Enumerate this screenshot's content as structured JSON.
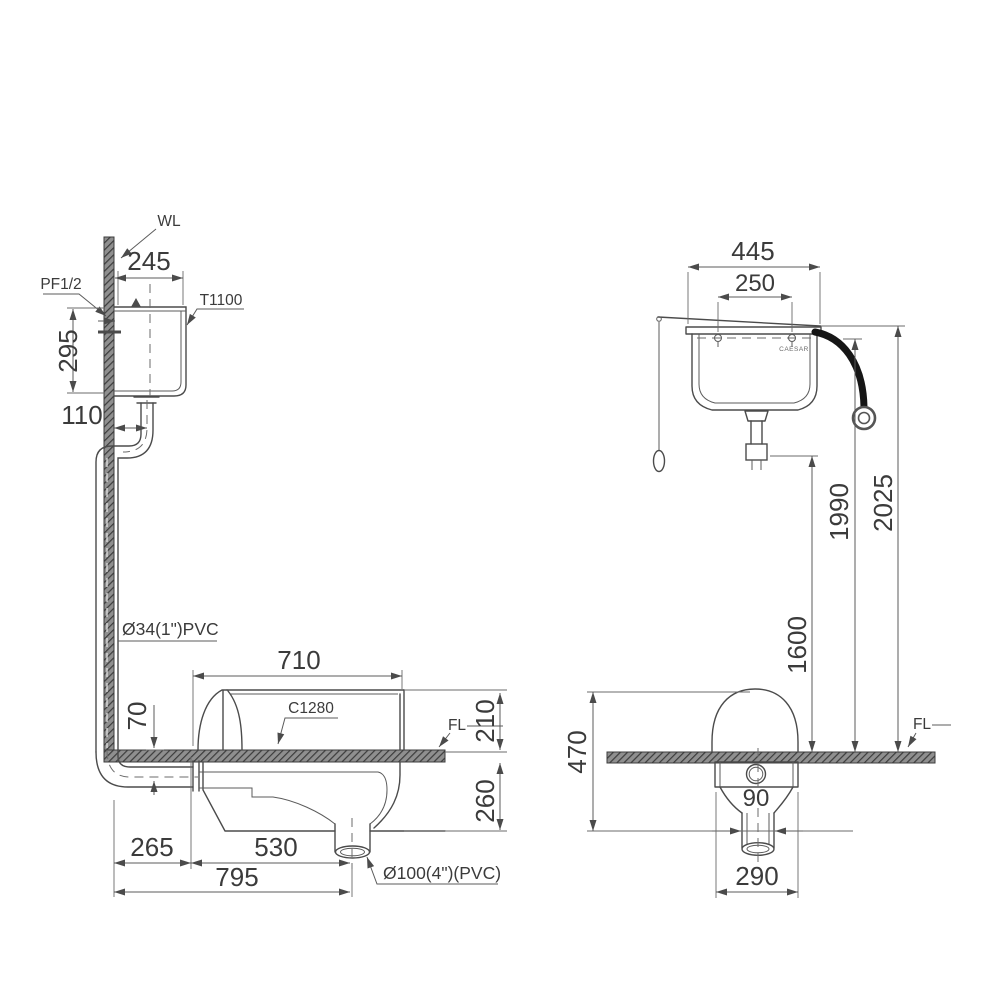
{
  "side_view": {
    "wall_label": "WL",
    "supply_label": "PF1/2",
    "tank_model": "T1100",
    "pan_model": "C1280",
    "floor_label": "FL",
    "flush_pipe_label": "Ø34(1\")PVC",
    "drain_label": "Ø100(4\")(PVC)",
    "dim_tank_width": "245",
    "dim_tank_height": "295",
    "dim_pipe_offset": "110",
    "dim_pan_length": "710",
    "dim_pipe_depth": "70",
    "dim_rim_height": "210",
    "dim_below_floor": "260",
    "dim_wall_to_pan": "265",
    "dim_pan_to_outlet": "530",
    "dim_wall_to_outlet": "795"
  },
  "front_view": {
    "brand": "CAESAR",
    "floor_label": "FL",
    "dim_tank_width": "445",
    "dim_bolt_spacing": "250",
    "dim_tank_top_height": "2025",
    "dim_inlet_height": "1990",
    "dim_spud_height": "1600",
    "dim_pan_total_depth": "470",
    "dim_outlet_dia": "90",
    "dim_body_width": "290"
  }
}
